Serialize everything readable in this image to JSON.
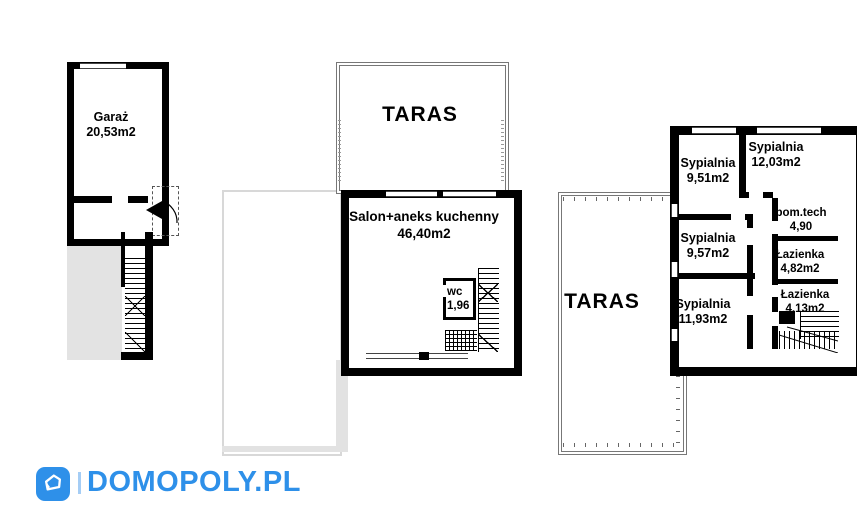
{
  "plans": {
    "garage_floor": {
      "garage": {
        "name": "Garaż",
        "area": "20,53m2"
      }
    },
    "ground_floor": {
      "taras_label": "TARAS",
      "salon": {
        "name": "Salon+aneks kuchenny",
        "area": "46,40m2"
      },
      "wc": {
        "name": "wc",
        "area": "1,96"
      }
    },
    "upper_floor": {
      "taras_label": "TARAS",
      "rooms": [
        {
          "name": "Sypialnia",
          "area": "9,51m2"
        },
        {
          "name": "Sypialnia",
          "area": "12,03m2"
        },
        {
          "name": "pom.tech",
          "area": "4,90"
        },
        {
          "name": "Sypialnia",
          "area": "9,57m2"
        },
        {
          "name": "Łazienka",
          "area": "4,82m2"
        },
        {
          "name": "Sypialnia",
          "area": "11,93m2"
        },
        {
          "name": "Łazienka",
          "area": "4,13m2"
        }
      ]
    }
  },
  "logo": {
    "text": "DOMOPOLY.PL"
  },
  "colors": {
    "brand_blue": "#2E90E9",
    "brand_blue_light": "#A5CDF5",
    "wall_black": "#000000",
    "paving_gray": "#E3E3E3",
    "taras_border_gray": "#777777"
  }
}
